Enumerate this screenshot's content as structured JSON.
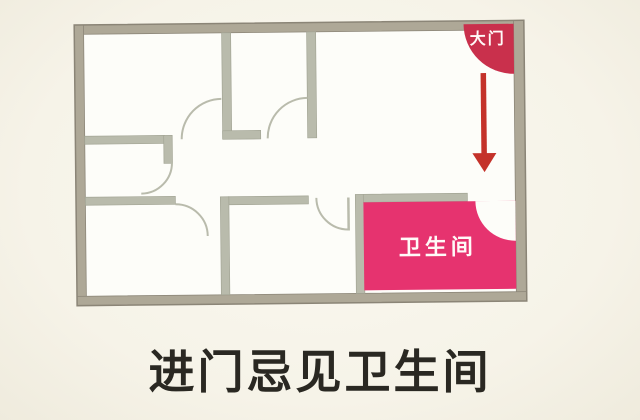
{
  "figure": {
    "caption": "进门忌见卫生间"
  },
  "plan": {
    "entry_door_label": "大门",
    "bathroom_label": "卫生间"
  },
  "colors": {
    "background_cream": "#f6f3e8",
    "floor_white": "#fdfdf9",
    "inner_wall_gray": "#b9bbac",
    "outer_wall_taupe": "#aea897",
    "bathroom_pink": "#e6336f",
    "entry_door_red": "#c9304c",
    "arrow_red": "#c4322a",
    "label_white": "#fffaf8",
    "caption_black": "#2a2822"
  }
}
